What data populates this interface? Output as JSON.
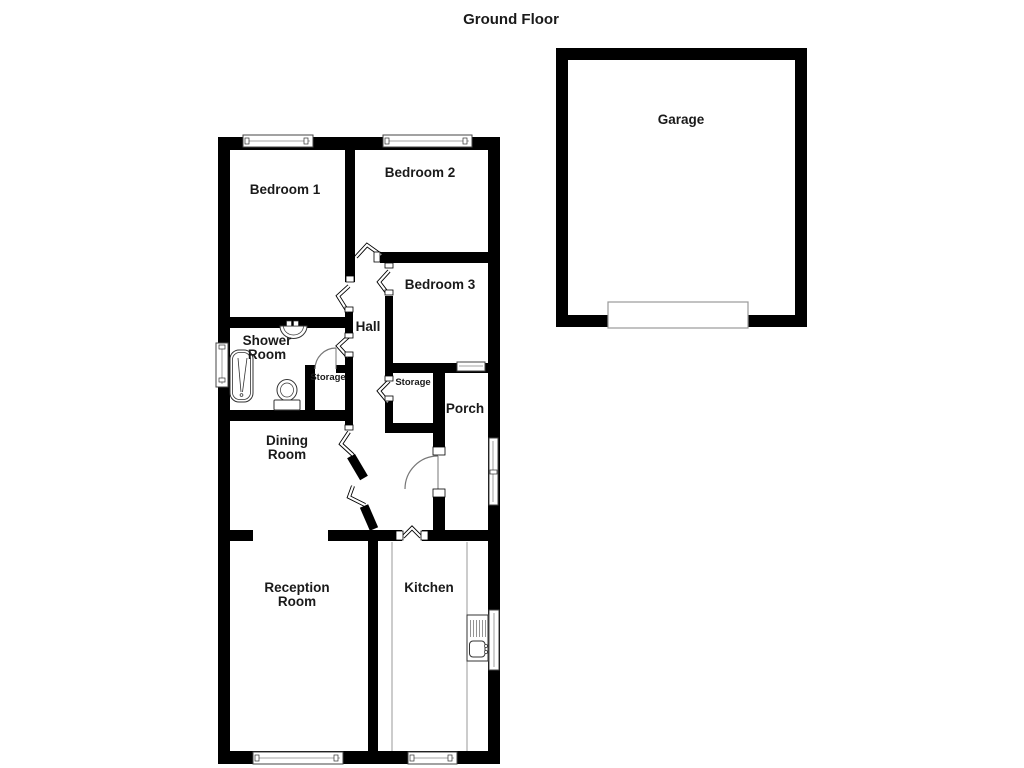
{
  "header": {
    "title": "Ground Floor"
  },
  "floorplan": {
    "rooms": {
      "bedroom1": {
        "label": "Bedroom 1"
      },
      "bedroom2": {
        "label": "Bedroom 2"
      },
      "bedroom3": {
        "label": "Bedroom 3"
      },
      "hall": {
        "label": "Hall"
      },
      "shower_room": {
        "label": "Shower Room"
      },
      "storage_hall": {
        "label": "Storage"
      },
      "storage_porch": {
        "label": "Storage"
      },
      "porch": {
        "label": "Porch"
      },
      "dining_room": {
        "label": "Dining Room"
      },
      "reception_room": {
        "label": "Reception Room"
      },
      "kitchen": {
        "label": "Kitchen"
      },
      "garage": {
        "label": "Garage"
      }
    },
    "fixtures": [
      "bath",
      "wash-basin",
      "toilet",
      "kitchen-sink",
      "garage-door"
    ],
    "colors": {
      "wall": "#000000",
      "label_text": "#1a1a1a",
      "window_frame": "#444444",
      "door_symbol": "#777777",
      "counter_line": "#999999",
      "background": "#ffffff"
    }
  }
}
